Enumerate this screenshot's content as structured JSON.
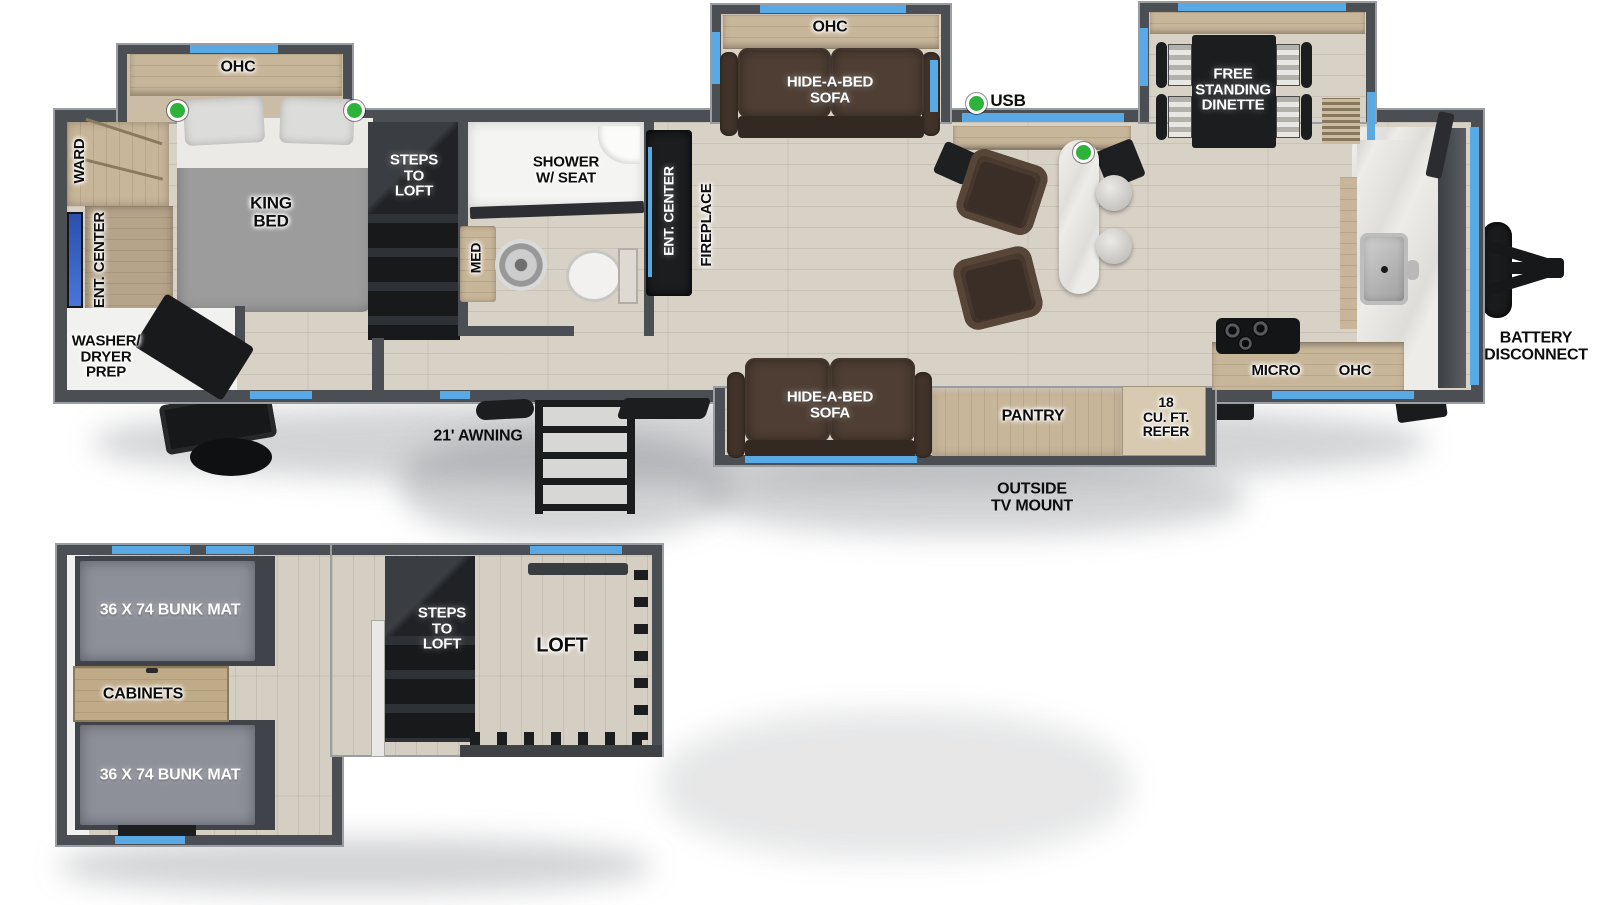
{
  "colors": {
    "wall": "#4b4f54",
    "window_blue": "#58a9e4",
    "floor_wood": "#d8d1c6",
    "cabinet_tan": "#c8b69a",
    "marble": "#edece8",
    "sofa_brown": "#4e3e33",
    "unit_black": "#1b1d1f",
    "usb_green": "#2eb33a",
    "bunk_mat_gray": "#8d8f99",
    "tv_blue": "#3b63c9"
  },
  "main": {
    "bedroom": {
      "ohc": "OHC",
      "ward": "WARD",
      "ent_center": "ENT. CENTER",
      "king_bed": "KING\nBED",
      "washer_dryer": "WASHER/\nDRYER\nPREP"
    },
    "stairs": {
      "steps_to_loft": "STEPS\nTO\nLOFT"
    },
    "bath": {
      "shower": "SHOWER\nW/ SEAT",
      "med": "MED"
    },
    "living": {
      "ent_center": "ENT. CENTER",
      "fireplace": "FIREPLACE",
      "sofa_ohc": "OHC",
      "hide_a_bed": "HIDE-A-BED\nSOFA",
      "usb": "USB",
      "dinette": "FREE\nSTANDING\nDINETTE"
    },
    "kitchen": {
      "micro": "MICRO",
      "ohc": "OHC",
      "refer": "18\nCU. FT.\nREFER",
      "pantry": "PANTRY"
    },
    "bottom": {
      "hide_a_bed": "HIDE-A-BED\nSOFA",
      "outside_tv": "OUTSIDE\nTV MOUNT",
      "awning": "21' AWNING"
    },
    "exterior": {
      "battery": "BATTERY\nDISCONNECT"
    }
  },
  "loft": {
    "bunk_top": "36 X 74 BUNK MAT",
    "cabinets": "CABINETS",
    "bunk_bottom": "36 X 74 BUNK MAT",
    "steps": "STEPS\nTO\nLOFT",
    "loft": "LOFT"
  }
}
